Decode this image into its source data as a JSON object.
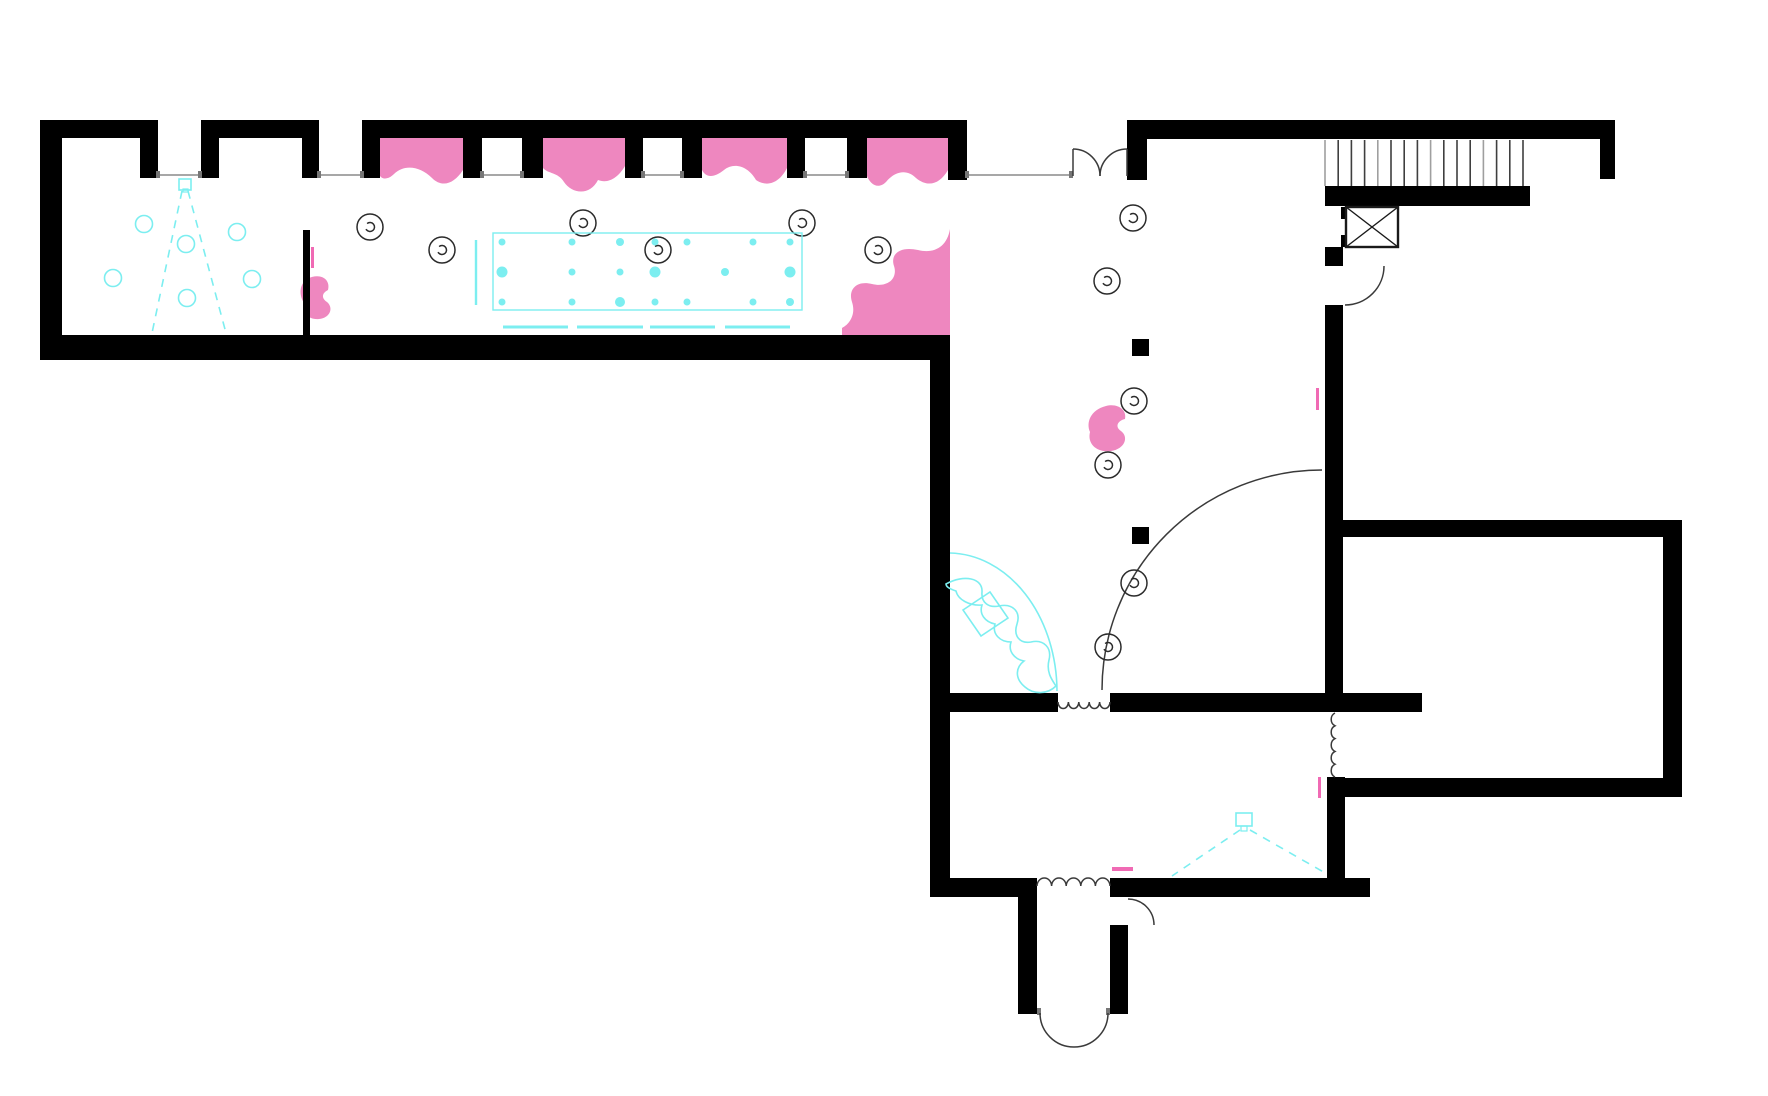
{
  "meta": {
    "width": 1768,
    "height": 1096,
    "kind": "architectural-floor-plan"
  },
  "colors": {
    "background": "#ffffff",
    "wall": "#000000",
    "door_line": "#3a3a3a",
    "window_line": "#8a8a8a",
    "jamb": "#777777",
    "pink": "#ee87bf",
    "pink_tick": "#f06ab4",
    "cyan": "#7ceef0",
    "stair_dark": "#3f3f3f",
    "stair_light": "#9f9f9f",
    "light_outline": "#2b2b2b"
  },
  "walls": [
    [
      40,
      120,
      22,
      240
    ],
    [
      40,
      120,
      118,
      18
    ],
    [
      140,
      138,
      18,
      40
    ],
    [
      201,
      120,
      118,
      18
    ],
    [
      201,
      138,
      18,
      40
    ],
    [
      302,
      138,
      17,
      40
    ],
    [
      362,
      120,
      605,
      18
    ],
    [
      362,
      138,
      18,
      40
    ],
    [
      463,
      138,
      19,
      40
    ],
    [
      522,
      138,
      21,
      40
    ],
    [
      625,
      138,
      18,
      40
    ],
    [
      682,
      138,
      20,
      40
    ],
    [
      787,
      138,
      18,
      40
    ],
    [
      847,
      138,
      20,
      40
    ],
    [
      948,
      138,
      19,
      42
    ],
    [
      303,
      230,
      7,
      105
    ],
    [
      40,
      335,
      910,
      25
    ],
    [
      930,
      335,
      20,
      562
    ],
    [
      1127,
      120,
      488,
      19
    ],
    [
      1127,
      139,
      20,
      41
    ],
    [
      1600,
      139,
      15,
      40
    ],
    [
      1325,
      186,
      205,
      20
    ],
    [
      1325,
      247,
      18,
      19
    ],
    [
      1325,
      305,
      18,
      388
    ],
    [
      1342,
      520,
      340,
      17
    ],
    [
      1663,
      520,
      19,
      277
    ],
    [
      1330,
      778,
      352,
      19
    ],
    [
      945,
      693,
      113,
      19
    ],
    [
      1110,
      693,
      312,
      19
    ],
    [
      1327,
      777,
      18,
      113
    ],
    [
      930,
      878,
      107,
      19
    ],
    [
      1110,
      878,
      260,
      19
    ],
    [
      1018,
      897,
      19,
      117
    ],
    [
      1110,
      925,
      18,
      89
    ],
    [
      1132,
      339,
      17,
      17
    ],
    [
      1132,
      527,
      17,
      17
    ],
    [
      1341,
      207,
      5,
      12
    ],
    [
      1341,
      235,
      5,
      12
    ]
  ],
  "window_lines": {
    "y": 175,
    "segments": [
      [
        158,
        200
      ],
      [
        319,
        362
      ],
      [
        482,
        522
      ],
      [
        643,
        682
      ],
      [
        805,
        847
      ],
      [
        967,
        1071
      ]
    ]
  },
  "jamb_nubs": [
    [
      1037,
      1008,
      4,
      7
    ],
    [
      1106,
      1008,
      4,
      7
    ]
  ],
  "bays": [
    "M380,138 L463,138 L463,170 C454,184 442,188 432,178 C420,166 404,164 394,174 C389,179 383,180 380,176 Z",
    "M543,138 L625,138 L625,166 C618,178 608,184 598,180 C590,196 572,194 564,182 C558,172 548,174 543,168 Z",
    "M702,138 L787,138 L787,168 C780,182 768,188 756,180 C748,166 734,162 724,170 C714,178 706,178 702,170 Z",
    "M867,138 L948,138 L948,170 C940,184 928,188 916,178 C906,168 894,172 886,182 C878,190 870,184 867,176 Z"
  ],
  "blobs": [
    "M307,279 C320,272 331,279 328,290 C322,293 321,298 327,302 C334,308 330,318 319,319 C308,320 301,312 304,303 C299,295 299,285 307,279 Z",
    "M950,229 C947,247 934,254 918,250 C900,246 890,254 894,266 C898,278 888,288 872,284 C856,280 848,290 852,302 C856,314 850,324 842,328 L842,335 L950,335 Z",
    "M1106,406 C1118,403 1127,410 1125,419 C1117,421 1115,427 1121,431 C1129,437 1125,449 1111,451 C1097,453 1087,444 1090,432 C1086,423 1090,410 1106,406 Z"
  ],
  "ticks": [
    [
      311,
      247,
      3,
      21
    ],
    [
      1316,
      388,
      3,
      22
    ],
    [
      1318,
      777,
      3,
      21
    ],
    [
      1112,
      867,
      21,
      4
    ]
  ],
  "stairs": {
    "x0": 1325,
    "dx": 13.2,
    "count": 16,
    "y0": 140,
    "y1": 186
  },
  "elevator": {
    "x": 1346,
    "y": 207,
    "w": 52,
    "h": 40
  },
  "door_arcs": [
    "M1073,149 A27,27 0 0 1 1100,176",
    "M1127,149 A27,27 0 0 0 1100,176",
    "M1384,266 A39,39 0 0 1 1345,305",
    "M1322,470 A220,220 0 0 0 1102,690",
    "M1128,899 A26,26 0 0 1 1154,925",
    "M1040,1013 A34,34 0 0 0 1074,1047",
    "M1108,1013 A34,34 0 0 1 1074,1047"
  ],
  "door_leaves": [
    [
      1073,
      149,
      1073,
      176
    ],
    [
      1127,
      149,
      1127,
      176
    ]
  ],
  "squiggles": [
    "M1058,702 A5.2,6.5 0 0 0 1068.4,702 A5.2,6.5 0 0 0 1078.8,702 A5.2,6.5 0 0 0 1089.2,702 A5.2,6.5 0 0 0 1099.6,702 A5.2,6.5 0 0 0 1110,702",
    "M1037,886 A7.3,8 0 0 1 1051.6,886 A7.3,8 0 0 1 1066.2,886 A7.3,8 0 0 1 1080.8,886 A7.3,8 0 0 1 1095.4,886 A7.3,8 0 0 1 1110,886",
    "M1335,713 A6.4,7 0 0 0 1335,725.8 A6.4,7 0 0 0 1335,738.6 A6.4,7 0 0 0 1335,751.4 A6.4,7 0 0 0 1335,764.2 A6.4,7 0 0 0 1335,777"
  ],
  "lights": [
    [
      370,
      227
    ],
    [
      442,
      250
    ],
    [
      583,
      223
    ],
    [
      658,
      250
    ],
    [
      802,
      223
    ],
    [
      878,
      250
    ],
    [
      1133,
      218
    ],
    [
      1107,
      281
    ],
    [
      1134,
      401
    ],
    [
      1108,
      465
    ],
    [
      1134,
      583
    ],
    [
      1108,
      647
    ]
  ],
  "cyan_circles": [
    [
      144,
      224
    ],
    [
      237,
      232
    ],
    [
      186,
      244
    ],
    [
      113,
      278
    ],
    [
      252,
      279
    ],
    [
      187,
      298
    ]
  ],
  "table": {
    "rect": [
      493,
      233,
      309,
      77
    ],
    "vline": [
      476,
      240,
      476,
      305
    ],
    "dash_y": 327,
    "dashes": [
      [
        503,
        568
      ],
      [
        577,
        643
      ],
      [
        650,
        715
      ],
      [
        725,
        790
      ]
    ],
    "dots": [
      [
        502,
        242,
        3.5
      ],
      [
        572,
        242,
        3.5
      ],
      [
        620,
        242,
        4
      ],
      [
        655,
        242,
        3.5
      ],
      [
        687,
        242,
        3.5
      ],
      [
        753,
        242,
        3.5
      ],
      [
        790,
        242,
        3.5
      ],
      [
        502,
        272,
        5.5
      ],
      [
        572,
        272,
        3.5
      ],
      [
        620,
        272,
        3.5
      ],
      [
        655,
        272,
        5.5
      ],
      [
        725,
        272,
        4
      ],
      [
        790,
        272,
        5.5
      ],
      [
        502,
        302,
        3.5
      ],
      [
        572,
        302,
        3.5
      ],
      [
        620,
        302,
        5
      ],
      [
        655,
        302,
        3.5
      ],
      [
        687,
        302,
        3.5
      ],
      [
        753,
        302,
        3.5
      ],
      [
        790,
        302,
        4
      ]
    ]
  },
  "desk": {
    "glass_arc": "M950,553 A109,139 0 0 1 1057,691",
    "body": "M946,584 C964,574 983,578 982,592 C981,603 989,608 999,606 C1013,603 1021,612 1017,624 C1013,636 1020,644 1031,642 C1044,639 1052,648 1049,660 C1046,672 1052,680 1056,686 C1048,694 1034,695 1025,687 C1014,678 1016,667 1024,661 C1014,659 1008,651 1011,642 C1000,642 992,634 995,624 C985,622 979,614 982,605 C970,606 958,600 956,591 C950,589 946,587 946,584 Z",
    "seat": "M963,610 L990,592 L1008,618 L981,636 Z"
  },
  "projectors": [
    {
      "square": [
        179,
        179,
        12,
        11
      ],
      "inner": [
        183,
        189,
        5,
        3
      ],
      "beams": [
        [
          182,
          191,
          152,
          333
        ],
        [
          188,
          191,
          226,
          333
        ]
      ]
    },
    {
      "square": [
        1236,
        813,
        16,
        13
      ],
      "inner": [
        1241,
        826,
        6,
        5
      ],
      "beams": [
        [
          1240,
          830,
          1172,
          876
        ],
        [
          1250,
          830,
          1327,
          874
        ]
      ]
    }
  ]
}
